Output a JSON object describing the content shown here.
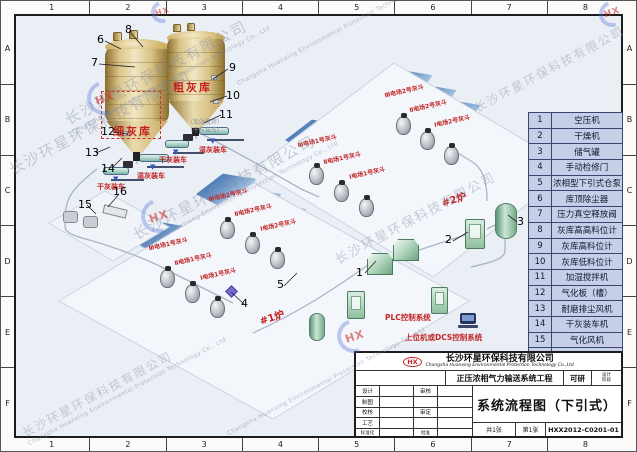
{
  "frame": {
    "cols": [
      "1",
      "2",
      "3",
      "4",
      "5",
      "6",
      "7",
      "8"
    ],
    "rows": [
      "A",
      "B",
      "C",
      "D",
      "E",
      "F"
    ]
  },
  "watermark": {
    "company_cn": "长沙环星环保科技有限公司",
    "company_en": "Changsha Huanxing Environmental Protection Technology Co., Ltd",
    "logo": "HX"
  },
  "icons": {
    "down_arrow": "▼"
  },
  "plant": {
    "fine_silo": "细灰库",
    "coarse_silo": "粗灰库",
    "wet_loading": "湿灰装车",
    "dry_loading": "干灰装车",
    "note_mixer": "（加湿搅拌）",
    "note_dry": "（干灰装车）",
    "unit1": "#1炉",
    "unit2": "#2炉",
    "hoppers": [
      "Ⅲ电场2号灰斗",
      "Ⅱ电场2号灰斗",
      "Ⅰ电场2号灰斗",
      "Ⅲ电场1号灰斗",
      "Ⅱ电场1号灰斗",
      "Ⅰ电场1号灰斗"
    ],
    "plc": "PLC控制系统",
    "dcs": "上位机或DCS控制系统"
  },
  "callouts": [
    "1",
    "2",
    "3",
    "4",
    "5",
    "6",
    "7",
    "8",
    "9",
    "10",
    "11",
    "12",
    "13",
    "14",
    "15",
    "16"
  ],
  "legend": {
    "rows": [
      {
        "num": "1",
        "name": "空压机"
      },
      {
        "num": "2",
        "name": "干燥机"
      },
      {
        "num": "3",
        "name": "储气罐"
      },
      {
        "num": "4",
        "name": "手动检修门"
      },
      {
        "num": "5",
        "name": "浓相型下引式仓泵"
      },
      {
        "num": "6",
        "name": "库顶除尘器"
      },
      {
        "num": "7",
        "name": "压力真空释放阀"
      },
      {
        "num": "8",
        "name": "灰库高高料位计"
      },
      {
        "num": "9",
        "name": "灰库高料位计"
      },
      {
        "num": "10",
        "name": "灰库低料位计"
      },
      {
        "num": "11",
        "name": "加湿搅拌机"
      },
      {
        "num": "12",
        "name": "气化板（槽）"
      },
      {
        "num": "13",
        "name": "耐磨排尘风机"
      },
      {
        "num": "14",
        "name": "干灰装车机"
      },
      {
        "num": "15",
        "name": "气化风机"
      },
      {
        "num": "16",
        "name": "电加热器"
      }
    ]
  },
  "titleblock": {
    "logo": "HX",
    "company_cn": "长沙环星环保科技有限公司",
    "company_en": "Changsha Huanxing Environmental Protection Technology Co.,Ltd",
    "project": "正压浓相气力输送系统工程",
    "stage": "可研",
    "stage_top": "设计",
    "stage_bottom": "阶段",
    "f_design": "设计",
    "f_draft": "制图",
    "f_check": "校核",
    "f_process": "工艺",
    "f_standard": "标准化",
    "f_review": "审核",
    "f_approve": "审定",
    "f_ratify": "批准",
    "sheets_total": "共1张",
    "sheet_no": "第1张",
    "title": "系统流程图（下引式）",
    "drawing_no": "HXX2012-C0201-01"
  }
}
